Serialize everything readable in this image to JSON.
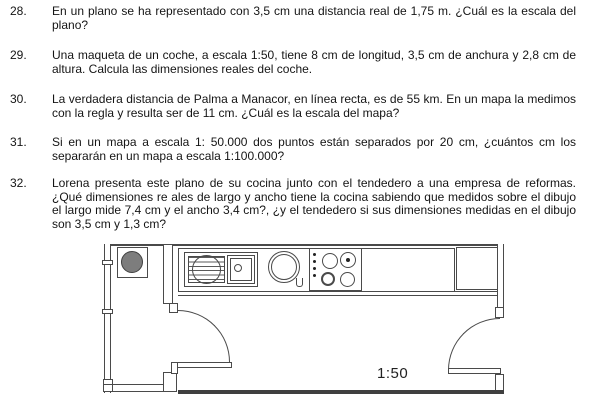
{
  "problems": [
    {
      "number": "28.",
      "text": "En un plano se ha representado con 3,5 cm una distancia real de 1,75 m. ¿Cuál es la escala del plano?"
    },
    {
      "number": "29.",
      "text": "Una maqueta de un coche, a escala 1:50, tiene 8 cm de longitud, 3,5 cm de anchura y 2,8 cm de altura. Calcula las dimensiones reales del coche."
    },
    {
      "number": "30.",
      "text": "La verdadera distancia de Palma a Manacor, en línea recta, es de 55 km. En un mapa la medimos con la regla y resulta ser de 11 cm. ¿Cuál es la escala del mapa?"
    },
    {
      "number": "31.",
      "text": "Si en un mapa a escala 1: 50.000 dos puntos están separados por 20 cm, ¿cuántos cm los separarán en un mapa a escala 1:100.000?"
    },
    {
      "number": "32.",
      "text": "Lorena presenta este plano de su cocina junto con el tendedero a una empresa de reformas. ¿Qué dimensiones re ales de largo y ancho tiene la cocina sabiendo que medidos sobre el dibujo el largo mide 7,4 cm y el ancho 3,4 cm?, ¿y el tendedero si sus dimensiones medidas en el dibujo son 3,5 cm y 1,3 cm?"
    }
  ],
  "plan": {
    "scale_label": "1:50",
    "line_color": "#4a4a4a",
    "washer_drum_color": "#7d7d7d"
  }
}
